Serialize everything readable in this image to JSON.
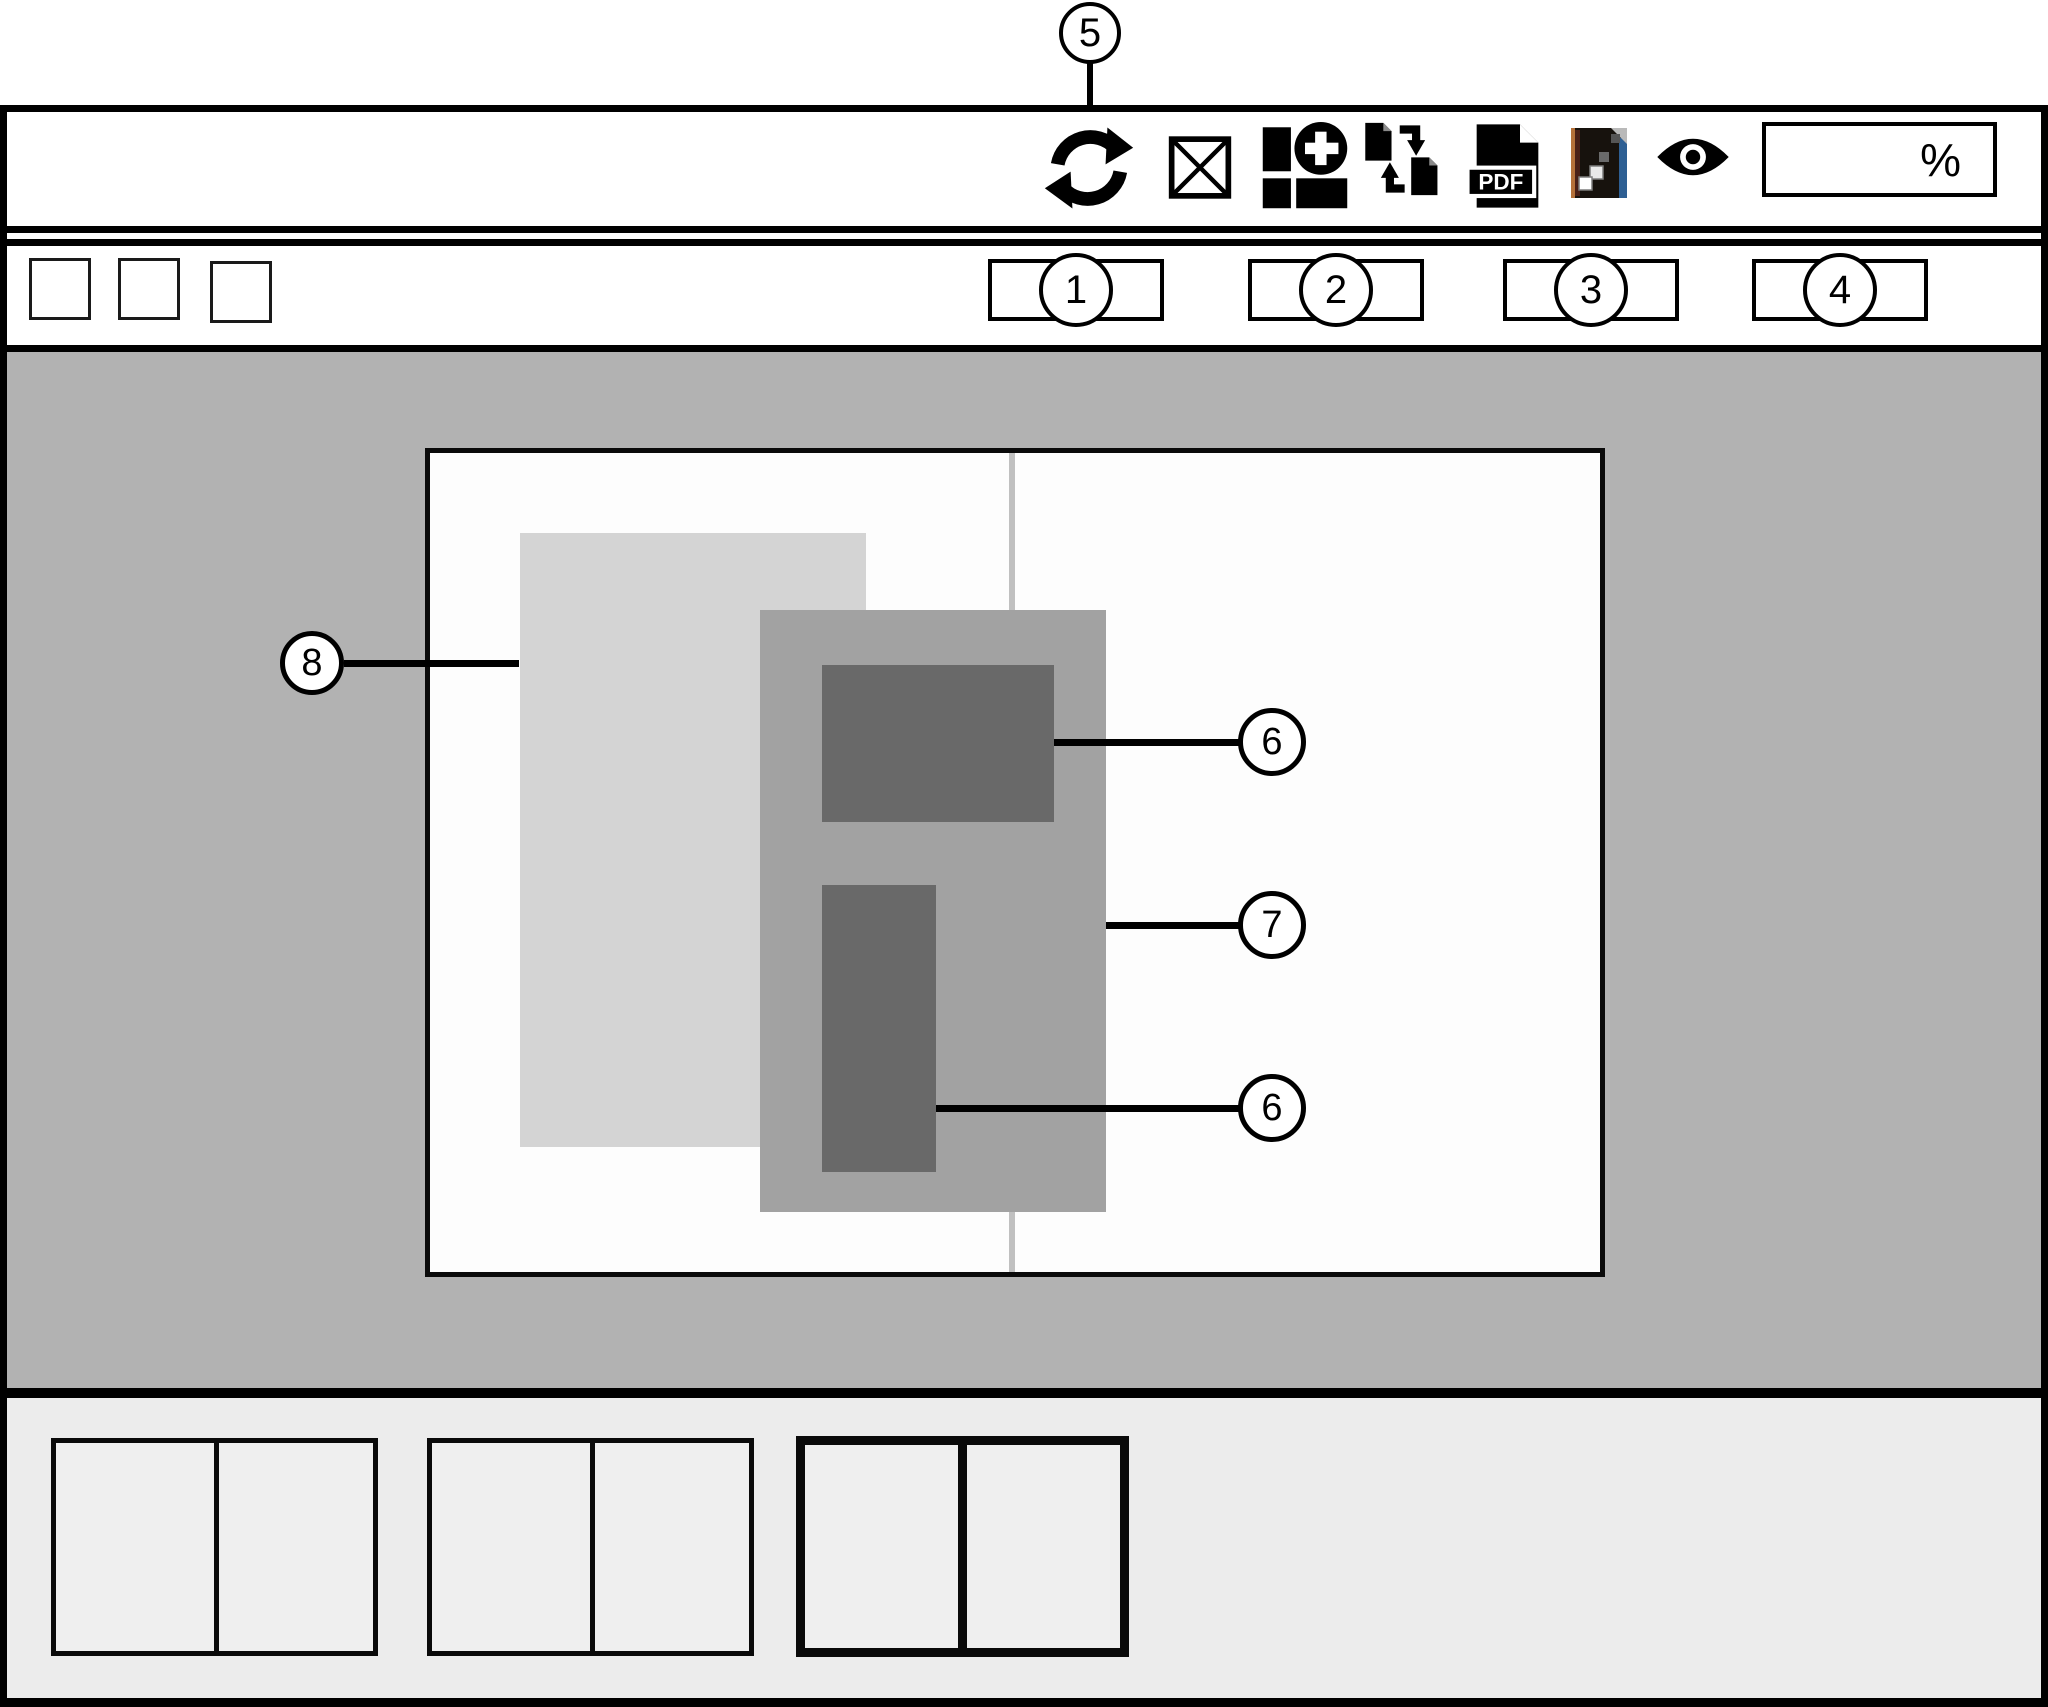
{
  "figure": {
    "description": "wireframe of page layout application window",
    "colors": {
      "canvas_gray": "#b2b2b2",
      "panel_gray": "#ececec",
      "page_white": "#fdfdfd",
      "spread_divider": "#c0c0c0",
      "placed_light": "#d4d4d4",
      "frame_medium": "#a2a2a2",
      "content_dark": "#696969",
      "line_black": "#000000",
      "file_icon_blue": "#2e5f93",
      "file_icon_orange": "#b5713a"
    }
  },
  "callouts": {
    "toolbar": "5",
    "slot1": "1",
    "slot2": "2",
    "slot3": "3",
    "slot4": "4",
    "content_top": "6",
    "frame": "7",
    "content_bottom": "6",
    "spread": "8"
  },
  "toolbar": {
    "icons": [
      "sync-refresh-icon",
      "image-placeholder-icon",
      "add-blocks-icon",
      "convert-pages-icon",
      "pdf-file-icon",
      "image-file-icon",
      "preview-eye-icon"
    ],
    "zoom_field": {
      "value": "",
      "suffix": "%"
    }
  },
  "pdf_icon": {
    "label": "PDF"
  }
}
